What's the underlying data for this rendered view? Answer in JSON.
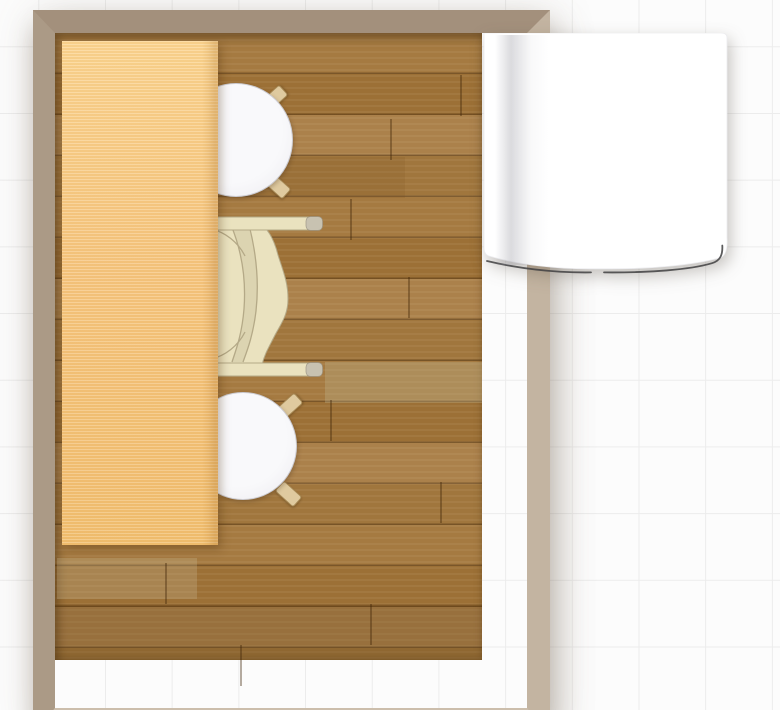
{
  "colors": {
    "canvas_bg": "#fcfcfc",
    "grid_line": "#ececec",
    "wall_top": "#a3907c",
    "wall_left": "#ab9a86",
    "wall_right": "#c3b4a1",
    "wall_bottom": "#ccbeac",
    "floor_base": "#a1773f",
    "floor_plank_a": "#a57a41",
    "floor_plank_b": "#9c7036",
    "floor_plank_c": "#ab814b",
    "floor_plank_d": "#a0763d",
    "table_wood": "#f6c57e",
    "table_wood_light": "#fbd490",
    "stool_seat": "#f9f9fb",
    "stool_leg": "#dfca9f",
    "chair_body": "#eae2bf",
    "chair_outline": "#b4a987",
    "chair_arm_tip": "#c8c2b1",
    "cabinet_fill": "#ffffff",
    "cabinet_edge_line": "#3f3f41"
  },
  "grid": {
    "cell_px": 66.7
  },
  "room": {
    "label": "room with wooden plank floor"
  },
  "furniture": [
    {
      "id": "table",
      "label": "rectangular light-wood table top"
    },
    {
      "id": "stool-top",
      "label": "round white chair, upper"
    },
    {
      "id": "armchair",
      "label": "cream wooden armchair"
    },
    {
      "id": "stool-bottom",
      "label": "round white chair, lower"
    },
    {
      "id": "cabinet",
      "label": "white cabinet with curved front edge"
    }
  ]
}
